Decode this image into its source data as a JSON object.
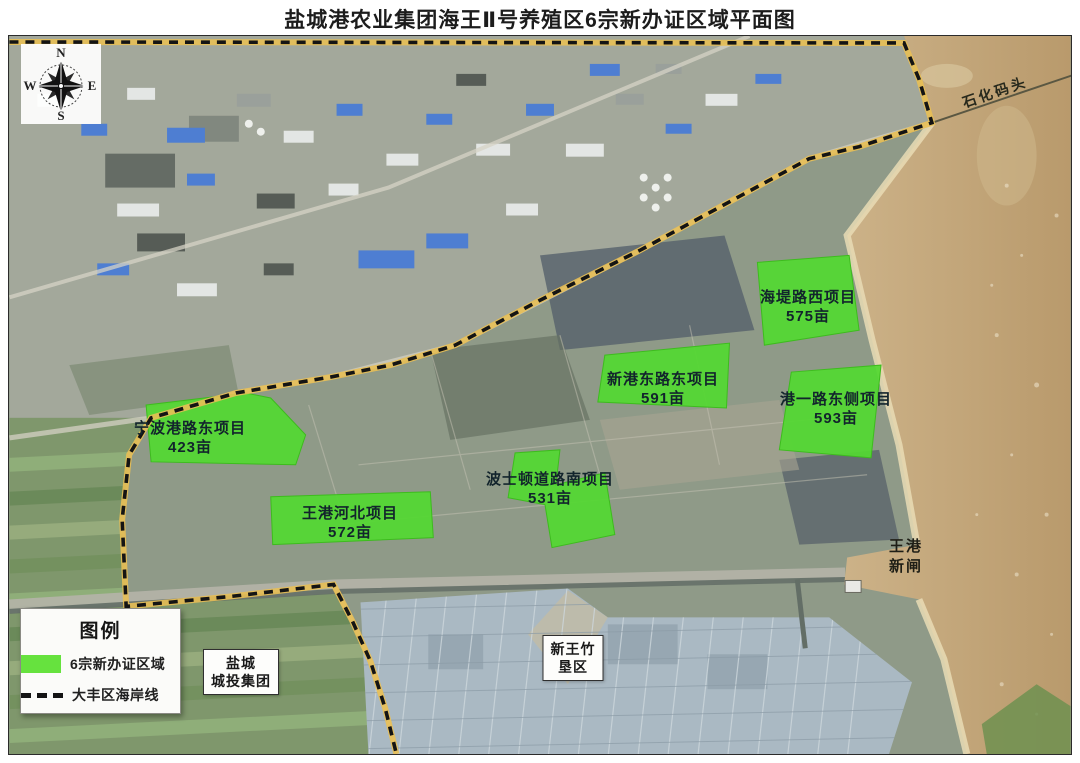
{
  "title": "盐城港农业集团海王Ⅱ号养殖区6宗新办证区域平面图",
  "compass": {
    "north": "N",
    "south": "S",
    "west": "W",
    "east": "E"
  },
  "parcels": [
    {
      "name": "海堤路西项目",
      "area": "575亩"
    },
    {
      "name": "新港东路东项目",
      "area": "591亩"
    },
    {
      "name": "港一路东侧项目",
      "area": "593亩"
    },
    {
      "name": "宁波港路东项目",
      "area": "423亩"
    },
    {
      "name": "波士顿道路南项目",
      "area": "531亩"
    },
    {
      "name": "王港河北项目",
      "area": "572亩"
    }
  ],
  "labels": {
    "pier": "石化码头",
    "sluice_line1": "王港",
    "sluice_line2": "新闸",
    "yancheng_line1": "盐城",
    "yancheng_line2": "城投集团",
    "reclamation_line1": "新王竹",
    "reclamation_line2": "垦区"
  },
  "legend": {
    "title": "图例",
    "items": [
      {
        "label": "6宗新办证区域"
      },
      {
        "label": "大丰区海岸线"
      }
    ]
  },
  "colors": {
    "parcel_green": "#53d832",
    "coastline_yellow": "#e8bf55",
    "coastline_dash": "#141414",
    "sea_tan": "#c3a87c"
  }
}
